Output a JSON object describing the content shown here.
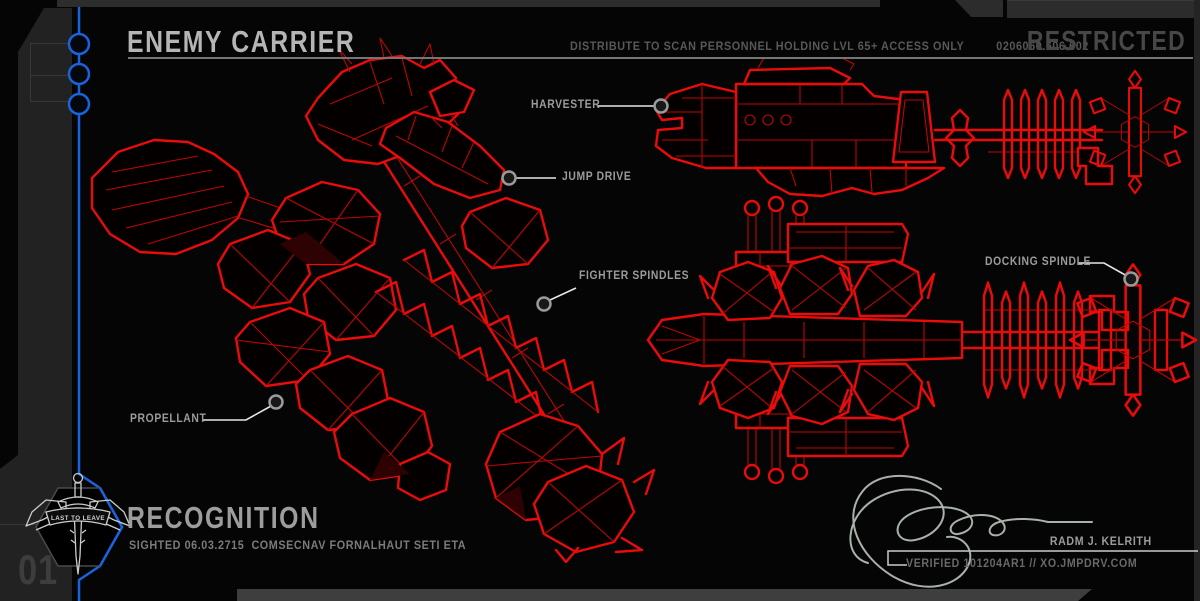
{
  "header": {
    "title": "ENEMY CARRIER",
    "distribution_notice": "DISTRIBUTE TO SCAN PERSONNEL HOLDING LVL 65+ ACCESS ONLY",
    "document_code": "0206060.606.602",
    "classification": "RESTRICTED"
  },
  "callouts": [
    {
      "label": "HARVESTER"
    },
    {
      "label": "JUMP DRIVE"
    },
    {
      "label": "FIGHTER SPINDLES"
    },
    {
      "label": "DOCKING SPINDLE"
    },
    {
      "label": "PROPELLANT"
    }
  ],
  "sidebar": {
    "page_number": "01",
    "badge_motto": "LAST TO LEAVE"
  },
  "footer": {
    "section_title": "RECOGNITION",
    "sighting_info": "SIGHTED 06.03.2715  COMSECNAV FORNALHAUT SETI ETA",
    "signer_name": "RADM J. KELRITH",
    "verification": "VERIFIED 101204AR1 // XO.JMPDRV.COM"
  },
  "colors": {
    "background": "#050505",
    "wireframe_red": "#ea0b0b",
    "accent_blue": "#1b62dd",
    "panel_gray": "#222222",
    "title_gray": "#b5b5b5"
  }
}
